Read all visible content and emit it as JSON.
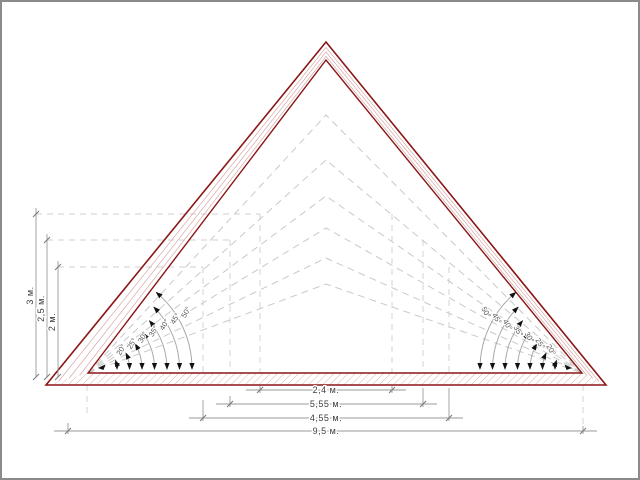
{
  "diagram": {
    "angle_labels": [
      "20°",
      "25°",
      "30°",
      "35°",
      "40°",
      "45°",
      "50°"
    ],
    "left_dimensions": {
      "d3": "3 м.",
      "d2_5": "2,5 м.",
      "d2": "2 м."
    },
    "bottom_dimensions": {
      "w2_4": "2,4 м.",
      "w5_55": "5,55 м.",
      "w4_55": "4,55 м.",
      "w9_5": "9,5 м."
    },
    "colors": {
      "roof_outline": "#8b1616",
      "hatch": "#dcaaaa",
      "dashed_lines": "#c9c9c9",
      "dimension_lines": "#9a9a9a",
      "text": "#3d3d3d",
      "frame": "#8a8a8a"
    }
  }
}
